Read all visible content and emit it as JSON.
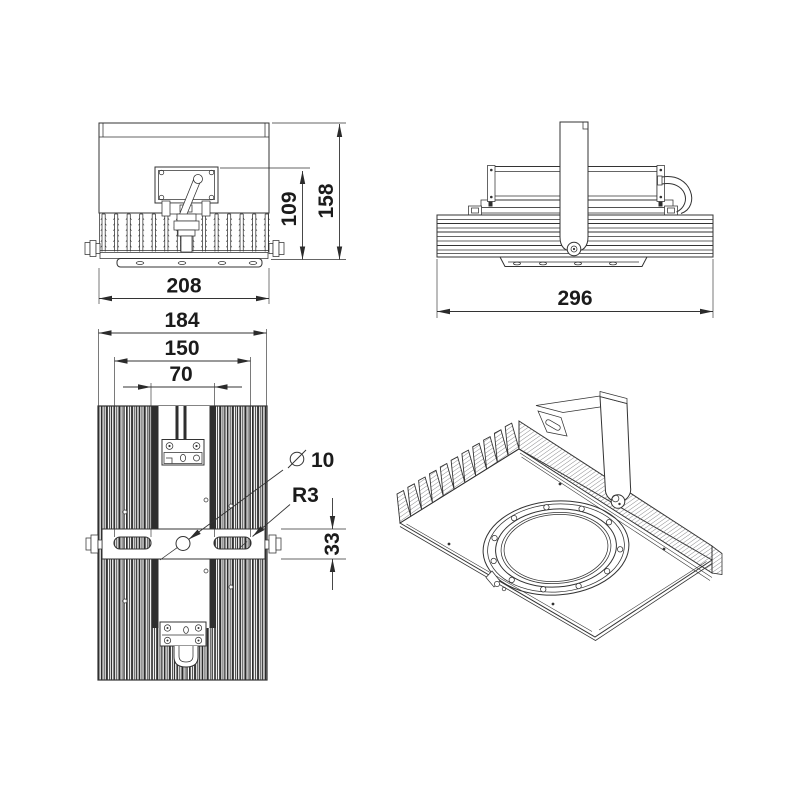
{
  "drawing": {
    "colors": {
      "line": "#333333",
      "background": "#ffffff"
    },
    "views": {
      "front": {
        "dims": {
          "width": "208",
          "inner_height": "109",
          "overall_height": "158"
        }
      },
      "side": {
        "dims": {
          "width": "296"
        }
      },
      "top": {
        "dims": {
          "overall_width": "184",
          "slot_span_outer": "150",
          "slot_span_inner": "70",
          "bracket_depth": "33"
        },
        "callouts": {
          "hole_diameter": "10",
          "slot_radius": "R3"
        }
      },
      "isometric": {}
    }
  }
}
